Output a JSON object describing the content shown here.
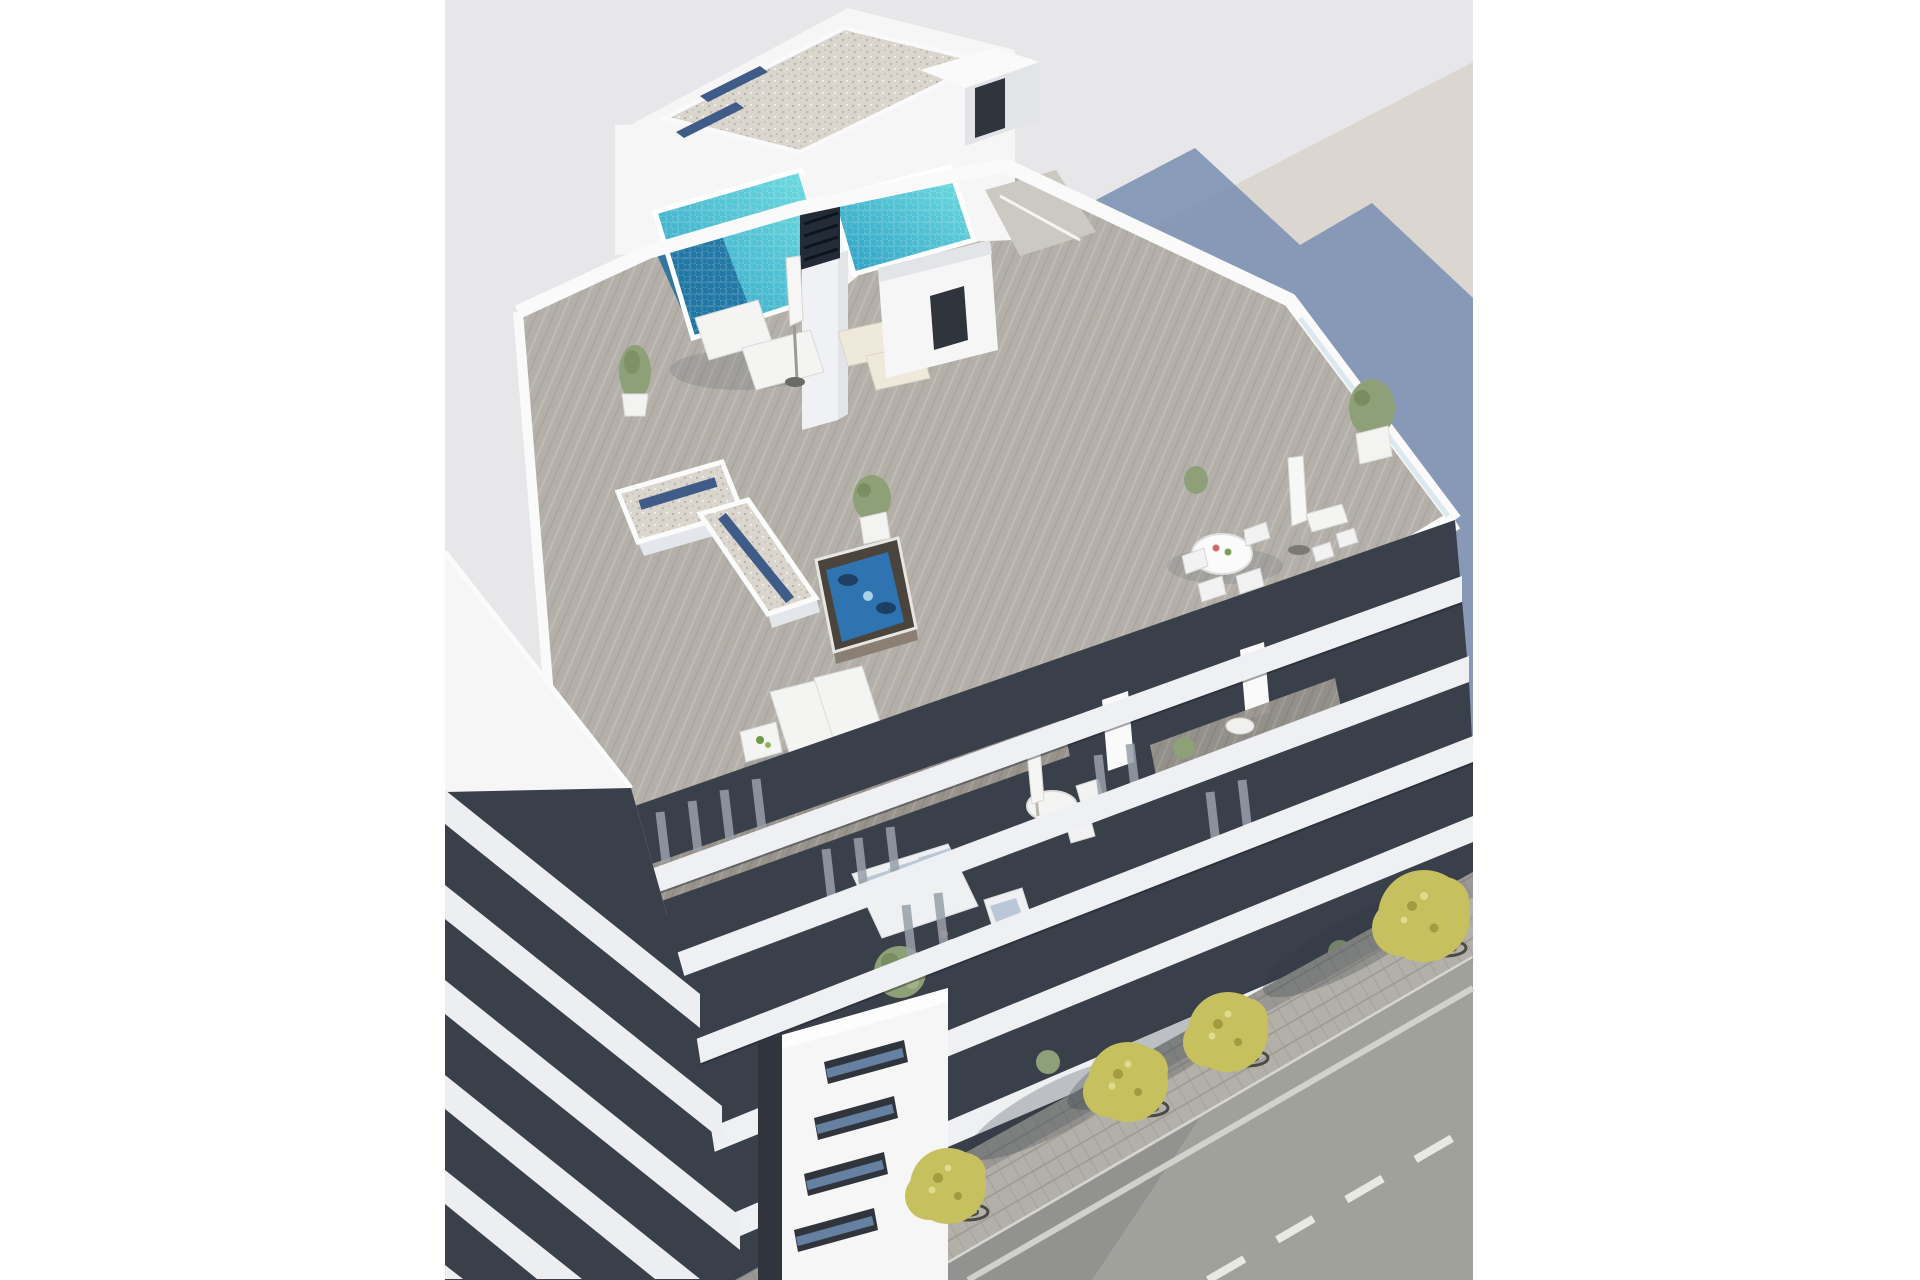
{
  "meta": {
    "type": "architectural-3d-render",
    "description": "Aerial 3D rendering of a modern white apartment building with a rooftop terrace: turquoise swimming pool, jacuzzi, sun loungers, parasols, dining sets and planters; lower floors with balcony terraces and outdoor sofa; white corner tower with slot windows; neighbouring buildings left and top-right; street with sidewalk, yellow-green trees and road markings at bottom right."
  },
  "scene": {
    "objects": [
      {
        "name": "render-backdrop",
        "note": "light gray ground plane"
      },
      {
        "name": "neighbor-ground",
        "note": "beige roof plane of adjacent lot, top right"
      },
      {
        "name": "building-shadow",
        "note": "stepped blue-gray shadow cast by the building"
      },
      {
        "name": "penthouse-gravel-roof",
        "note": "white gravel roof slab with blue glass strips"
      },
      {
        "name": "stair-bulkhead",
        "note": "white roof access box with dark door"
      },
      {
        "name": "rooftop-pool-left",
        "note": "turquoise pool with dark deep end"
      },
      {
        "name": "rooftop-pool-right",
        "note": "second turquoise pool"
      },
      {
        "name": "chimney-vent",
        "note": "dark louvered chimney on white pillar"
      },
      {
        "name": "roof-terrace-deck",
        "note": "gray wood deck terrace"
      },
      {
        "name": "planted-wall-t",
        "note": "T-shaped gravel-topped wall with blue strips"
      },
      {
        "name": "jacuzzi",
        "note": "hot tub with blue water"
      },
      {
        "name": "sun-loungers-upper",
        "note": "white and cream loungers with closed parasol"
      },
      {
        "name": "sun-loungers-mid",
        "note": "two white loungers with side table"
      },
      {
        "name": "outdoor-dining-set",
        "note": "round white table with chairs"
      },
      {
        "name": "bar-table-set",
        "note": "tall table with stools and closed parasol"
      },
      {
        "name": "potted-plants",
        "note": "green trees in white planters"
      },
      {
        "name": "sofa-terrace",
        "note": "fifth floor terrace with white sofa, blue cushions, armchair, bush"
      },
      {
        "name": "balcony-floors",
        "note": "stacked white slab bands with dark recessed balconies and curtains"
      },
      {
        "name": "corner-tower",
        "note": "white corner volume with four slot windows"
      },
      {
        "name": "neighbor-building-left",
        "note": "white wall and diagonal slab stripes"
      },
      {
        "name": "sidewalk",
        "note": "paver sidewalk with tree shadows"
      },
      {
        "name": "street-trees",
        "note": "four yellow-green trees with grates"
      },
      {
        "name": "road",
        "note": "asphalt with curb line, solid line and dashed center line"
      }
    ]
  },
  "palette": {
    "page-bg": "#ffffff",
    "render-bg": "#e7e7e9",
    "ground-beige": "#dbd7d0",
    "shadow-blue": "#8094b4",
    "building-white": "#f6f6f7",
    "wall-shade": "#e2e4e8",
    "parapet-white": "#fafafb",
    "slab-white": "#eef0f3",
    "facade-void": "#3a404a",
    "curtain": "#98a0aa",
    "gravel": "#dad6ce",
    "gravel-dot": "#bdb9b0",
    "glass-strip": "#3f5c88",
    "deck-wood": "#b4b0a9",
    "terrace-wood": "#98938c",
    "pool-bright": "#74e0e3",
    "pool-mid": "#2a9ec2",
    "pool-deep": "#1c6d9e",
    "chimney-dark": "#232b37",
    "door-dark": "#30353d",
    "window-blue": "#6c88ac",
    "sofa-white": "#eef0f2",
    "cushion-blue": "#b9c7d6",
    "furniture-white": "#f4f4f3",
    "cream": "#efe9dc",
    "hot-tub-shell": "#4a443c",
    "hot-tub-water": "#2f74b0",
    "plant-green": "#8da077",
    "planter-white": "#f3f3f2",
    "tree-yellow": "#c7c05e",
    "tree-yellow-dark": "#a29b3f",
    "tree-yellow-light": "#e1db8d",
    "trunk-brown": "#6b5e4c",
    "grate-dark": "#4a4a46",
    "sidewalk": "#b3b0a9",
    "paver-line": "#9d9a93",
    "asphalt": "#a1a19b",
    "curb-white": "#d7d7d2",
    "marking-white": "#e9e9e4"
  }
}
